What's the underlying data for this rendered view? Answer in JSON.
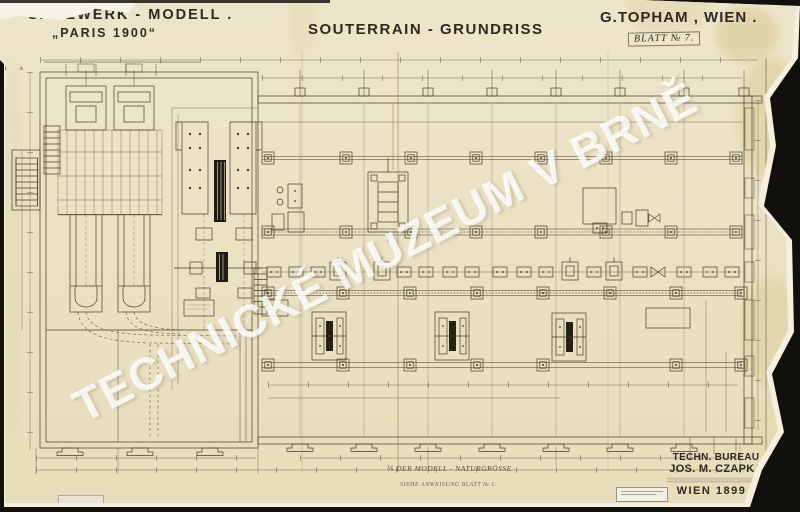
{
  "sheet": {
    "project_title": "SÄGEWERK - MODELL .",
    "project_subtitle": "„PARIS 1900“",
    "drawing_title": "SOUTERRAIN - GRUNDRISS",
    "author": "G.TOPHAM , WIEN .",
    "sheet_no": "BLATT № 7.",
    "axis_marks": "A A"
  },
  "scale_note": {
    "line1": "⅕  DER MODELL - NATURGRÖSSE",
    "line2": "SIEHE ANWEISUNG BLATT № 1."
  },
  "title_block": {
    "line1": "TECHN. BUREAU",
    "line2": "JOS. M. CZAPKA",
    "line3": "WIEN 1899 ."
  },
  "watermark": {
    "text": "TECHNICKÉ MUZEUM V BRNĚ"
  },
  "colors": {
    "paper": "#ebe2c4",
    "ink": "#453d2d",
    "background": "#12100c",
    "stain": "#d9c48e",
    "torn_edge": "#f6efdb",
    "watermark": "rgba(255,255,255,0.52)"
  }
}
